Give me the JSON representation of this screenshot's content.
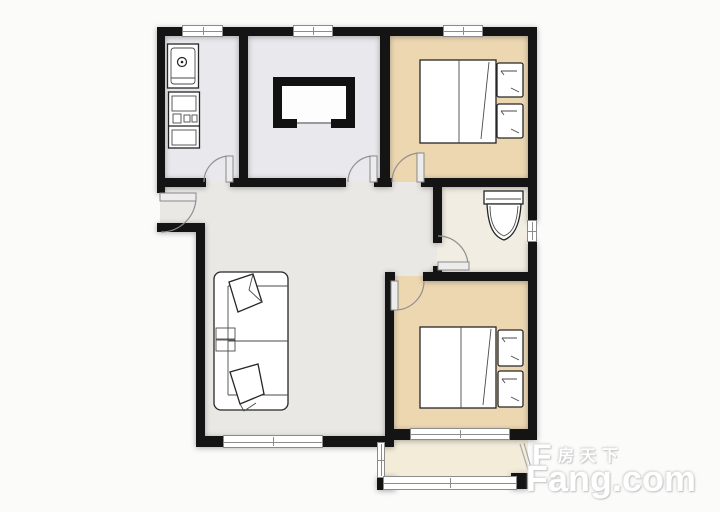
{
  "watermark": {
    "logo_letter": "F",
    "brand_cn": "房天下",
    "brand_en": "Fang.com"
  },
  "plan": {
    "type": "apartment-floor-plan",
    "rooms": [
      {
        "name": "kitchen",
        "furniture": [
          "sink",
          "stove"
        ]
      },
      {
        "name": "dining-room",
        "furniture": [
          "tv-cabinet"
        ]
      },
      {
        "name": "bedroom-top-right",
        "furniture": [
          "double-bed",
          "pillows"
        ]
      },
      {
        "name": "hallway",
        "furniture": []
      },
      {
        "name": "bathroom",
        "furniture": [
          "toilet"
        ]
      },
      {
        "name": "living-room",
        "furniture": [
          "sofa",
          "cushions"
        ]
      },
      {
        "name": "bedroom-bottom-right",
        "furniture": [
          "double-bed",
          "pillows"
        ]
      },
      {
        "name": "balcony",
        "furniture": []
      }
    ],
    "doors": [
      "entry-door",
      "kitchen-door",
      "dining-door",
      "bedroom1-door",
      "bathroom-door",
      "bedroom2-door"
    ],
    "windows": 8
  },
  "colors": {
    "wall": "#141414",
    "floor_cool_gray": "#e9e9ed",
    "floor_warm_gray": "#eae8e4",
    "floor_tan": "#ecd7b1",
    "floor_cream": "#f1ede2",
    "floor_balcony": "#f3ecd9",
    "window_frame": "#8c8c8c",
    "door_arc": "#8f8f8f",
    "watermark_text": "#ffffff",
    "page_background": "#fbfbfa"
  }
}
